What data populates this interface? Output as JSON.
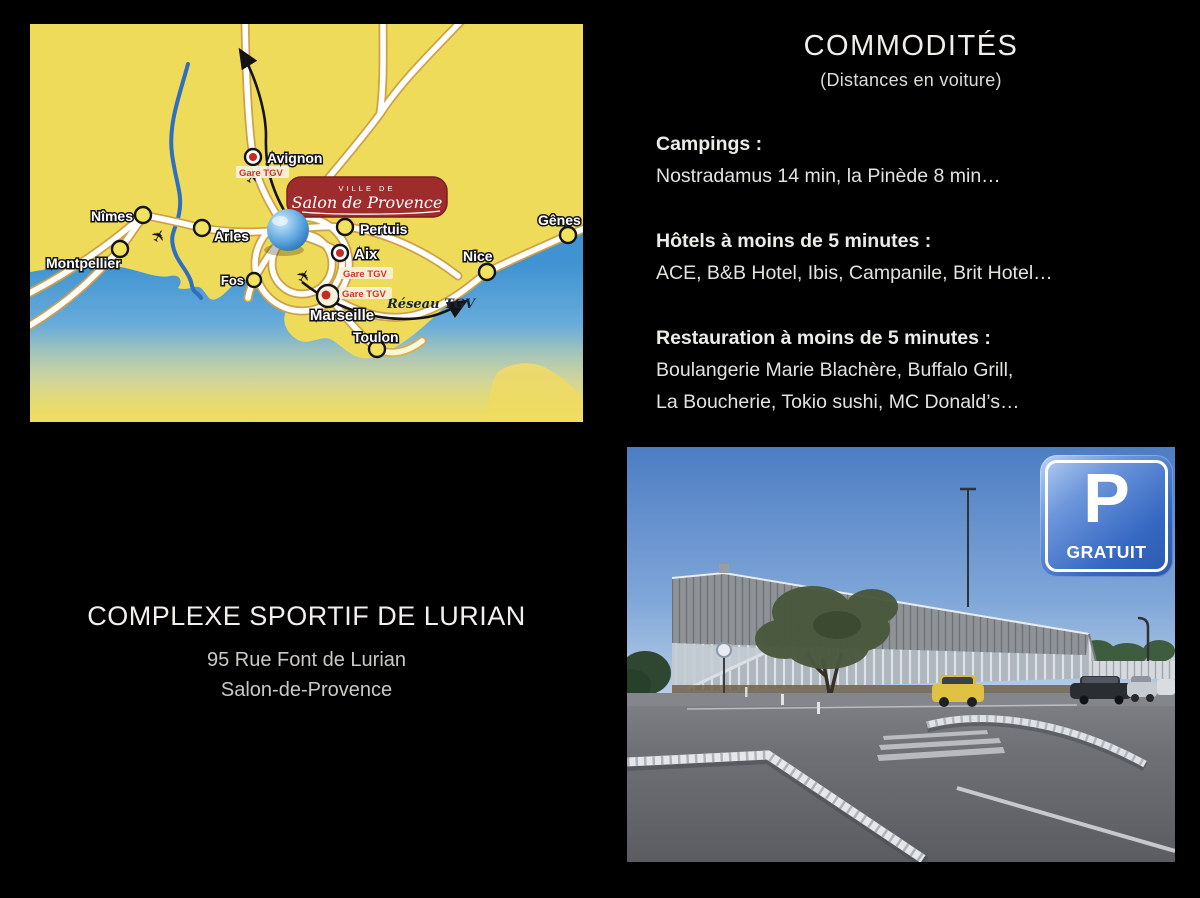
{
  "commodites": {
    "title": "COMMODITÉS",
    "subtitle": "(Distances en voiture)",
    "sections": [
      {
        "heading": "Campings :",
        "lines": [
          "Nostradamus 14 min, la Pinède 8 min…"
        ]
      },
      {
        "heading": "Hôtels à moins de 5 minutes :",
        "lines": [
          "ACE, B&B Hotel, Ibis, Campanile, Brit Hotel…"
        ]
      },
      {
        "heading": "Restauration à moins de 5 minutes :",
        "lines": [
          "Boulangerie Marie Blachère, Buffalo Grill,",
          "La Boucherie, Tokio sushi, MC Donald’s…"
        ]
      }
    ]
  },
  "venue": {
    "name": "COMPLEXE SPORTIF DE LURIAN",
    "address_line1": "95 Rue Font de Lurian",
    "address_line2": "Salon-de-Provence"
  },
  "map": {
    "banner": {
      "line1": "VILLE DE",
      "line2": "Salon de Provence"
    },
    "cities": [
      {
        "name": "Avignon",
        "station": true
      },
      {
        "name": "Nîmes",
        "station": false
      },
      {
        "name": "Arles",
        "station": false
      },
      {
        "name": "Montpellier",
        "station": false
      },
      {
        "name": "Pertuis",
        "station": false
      },
      {
        "name": "Aix",
        "station": true
      },
      {
        "name": "Fos",
        "station": false
      },
      {
        "name": "Marseille",
        "station": true
      },
      {
        "name": "Toulon",
        "station": false
      },
      {
        "name": "Nice",
        "station": false
      },
      {
        "name": "Gênes",
        "station": false
      }
    ],
    "labels": {
      "gare_tgv": "Gare TGV",
      "reseau_tgv": "Réseau TGV"
    },
    "colors": {
      "land": "#EFDB5A",
      "sea": "#3F93D2",
      "road_casing": "#CFA045",
      "banner_red": "#9E2C2C"
    }
  },
  "photo": {
    "sign": {
      "letter": "P",
      "caption": "GRATUIT",
      "color": "#2F64BE"
    }
  }
}
